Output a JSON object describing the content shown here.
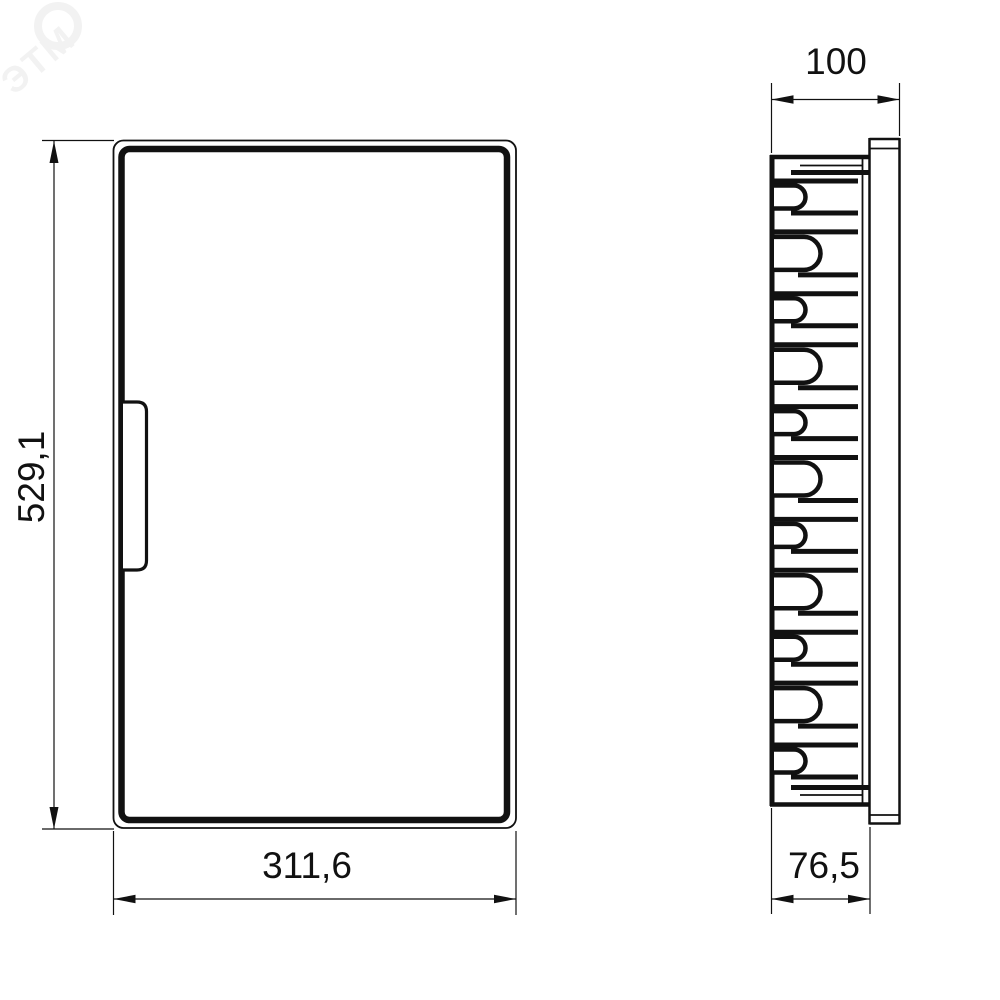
{
  "watermark": {
    "logo_text": "ЭТМ"
  },
  "views": {
    "front": {
      "height_dimension": "529,1",
      "width_dimension": "311,6"
    },
    "side": {
      "overall_depth_dimension": "100",
      "body_depth_dimension": "76,5",
      "clip_count": 11
    }
  },
  "colors": {
    "line": "#111111",
    "background": "#ffffff",
    "watermark": "#f2f2f2"
  }
}
